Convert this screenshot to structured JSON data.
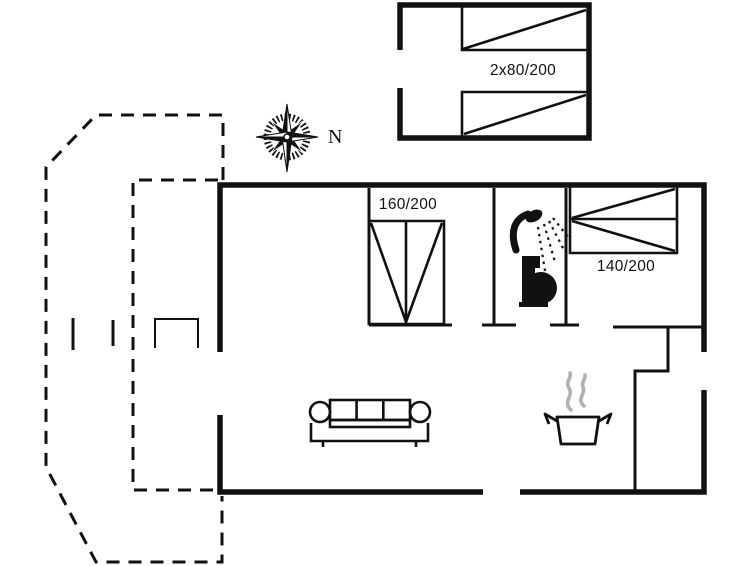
{
  "plan": {
    "kind": "holiday-home floor plan",
    "compass": {
      "label": "N"
    },
    "labels": {
      "annex_beds": "2x80/200",
      "bedroom1_bed": "160/200",
      "bedroom2_bed": "140/200"
    },
    "icons": {
      "compass": "compass-rose-icon",
      "bathroom": [
        "shower-icon",
        "toilet-icon"
      ],
      "living": [
        "sofa-icon"
      ],
      "kitchen": [
        "cooking-pot-icon",
        "steam-icon"
      ]
    },
    "colors": {
      "line": "#111111",
      "steam": "#b1b1b1",
      "background": "#ffffff"
    }
  }
}
